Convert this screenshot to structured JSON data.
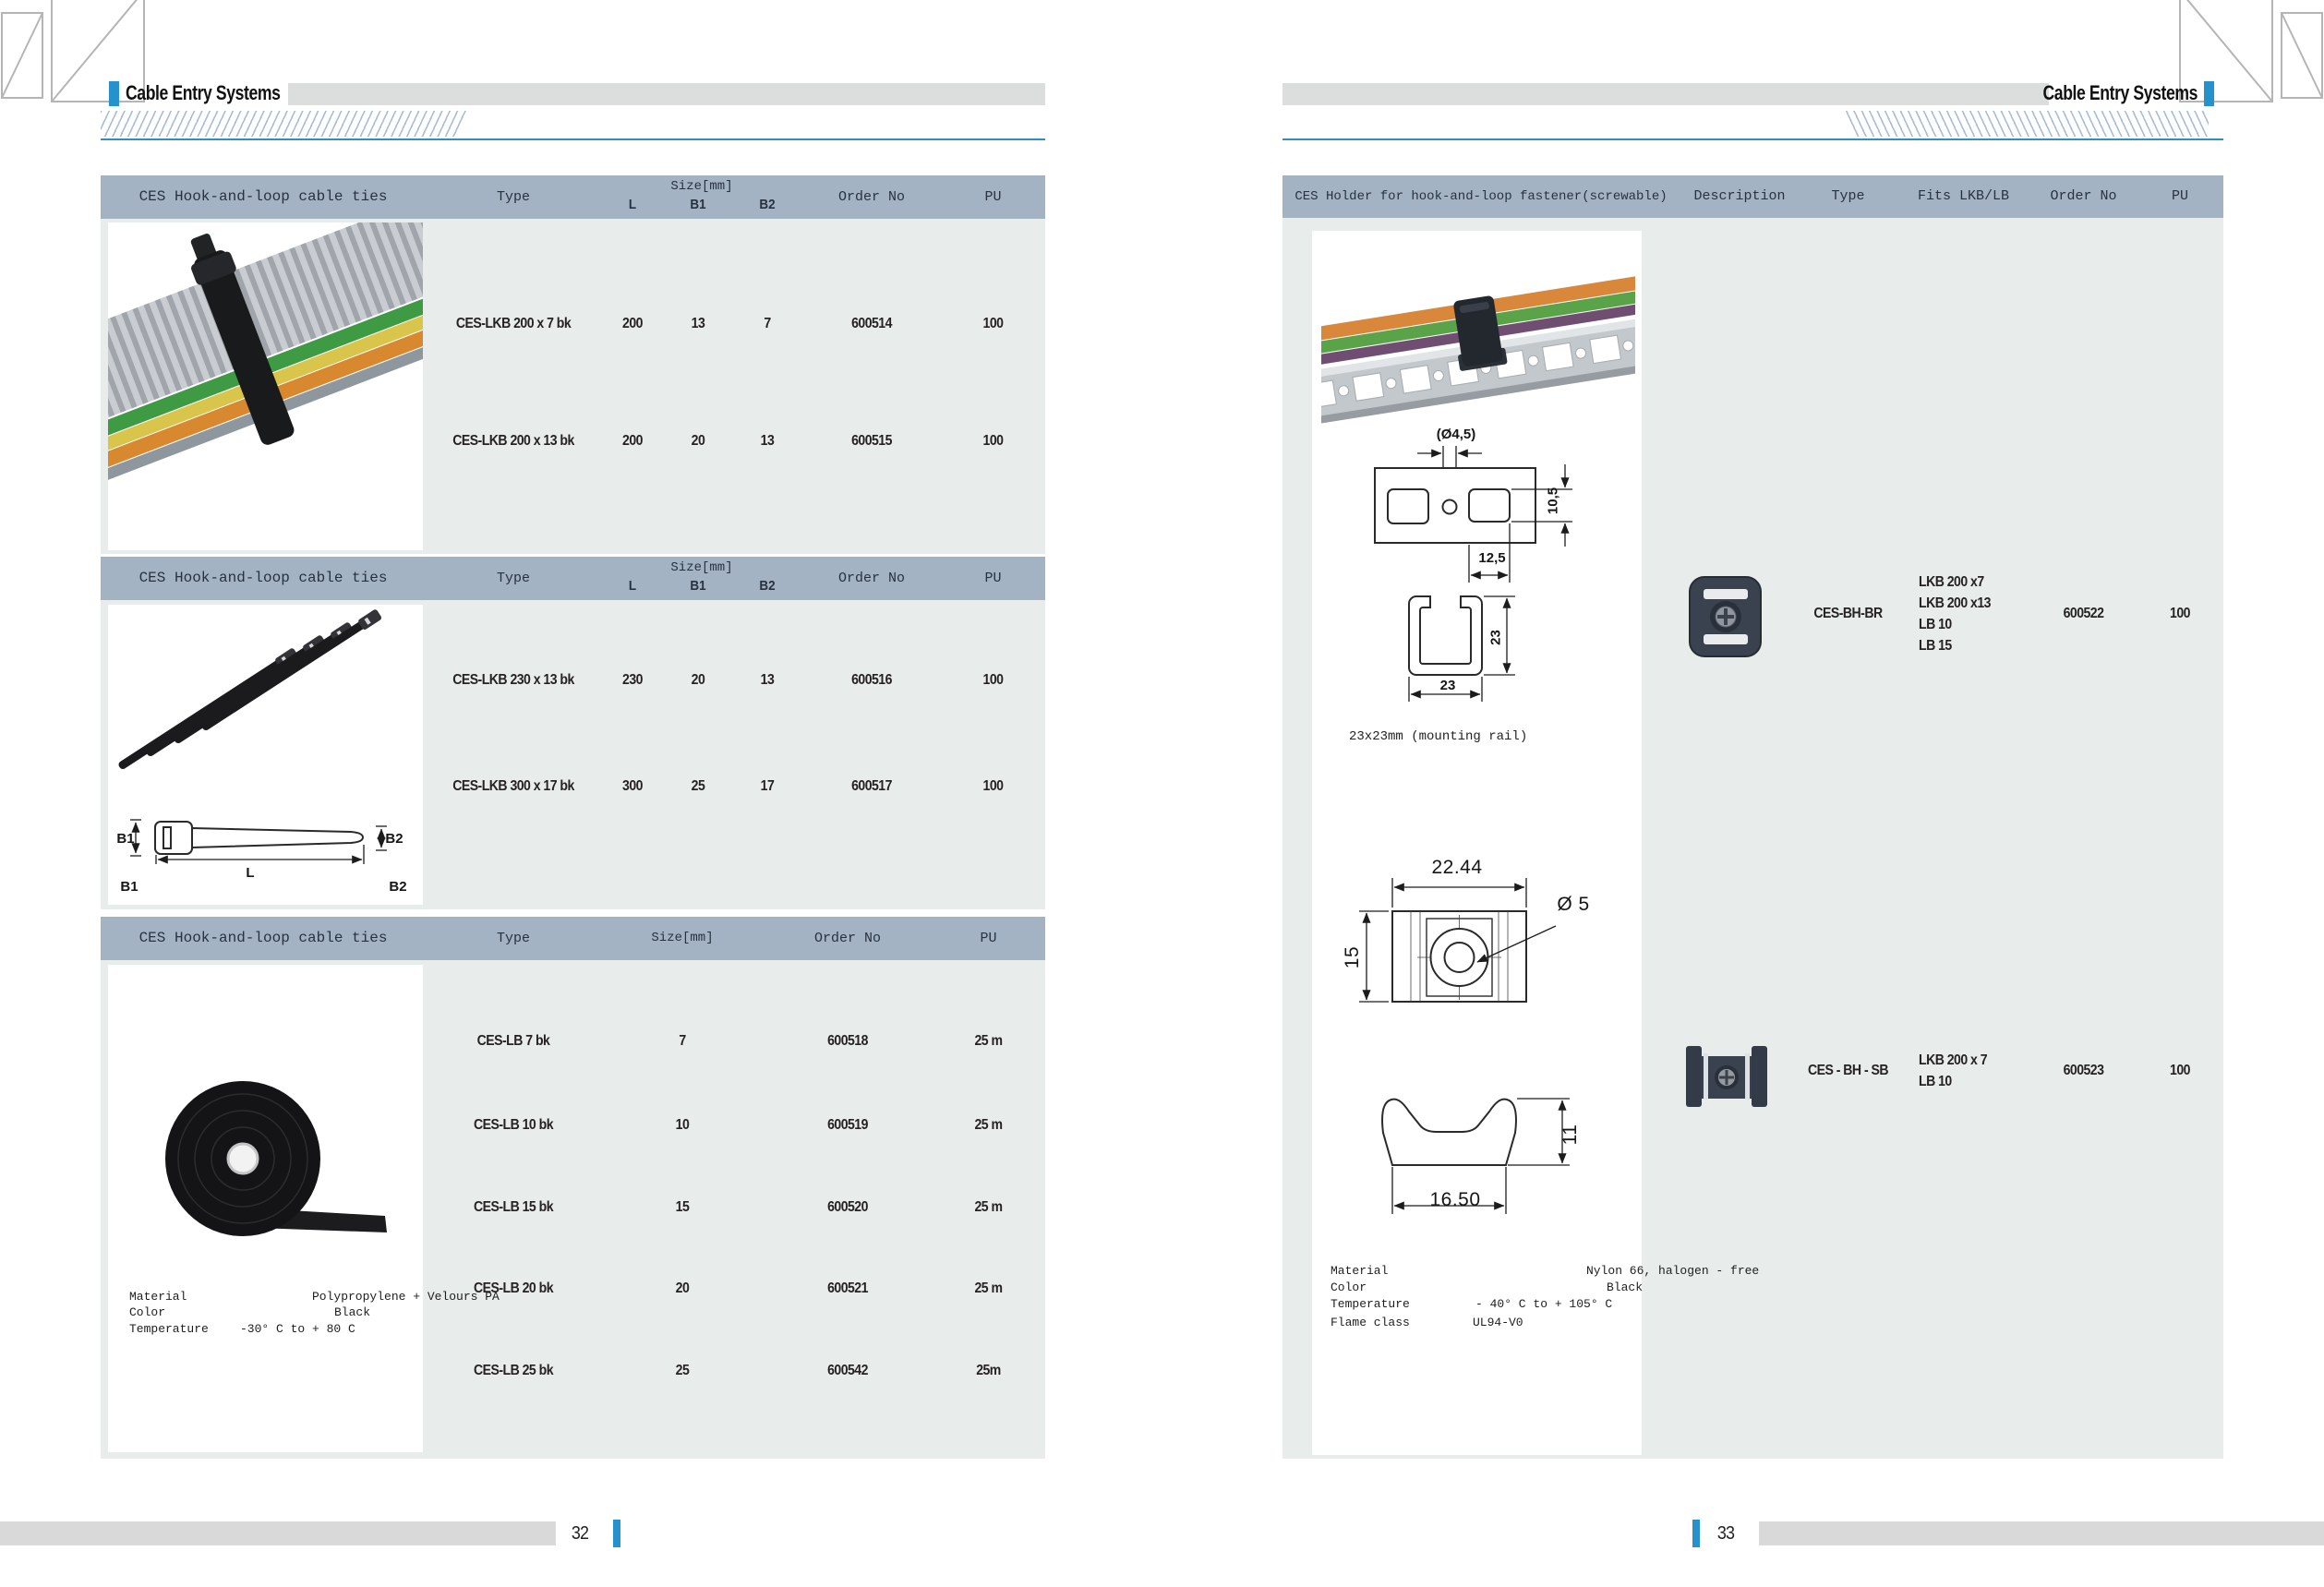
{
  "colors": {
    "accent_blue": "#2591cd",
    "header_band": "#a4b3c3",
    "table_body": "#e8eceb",
    "gray_band": "#dcdddd"
  },
  "left_page": {
    "header_title": "Cable Entry Systems",
    "page_number": "32",
    "lkb_columns": {
      "title": "CES Hook-and-loop cable ties",
      "type": "Type",
      "size": "Size[mm]",
      "l": "L",
      "b1": "B1",
      "b2": "B2",
      "order": "Order No",
      "pu": "PU"
    },
    "table1_rows": [
      {
        "type": "CES-LKB 200 x 7 bk",
        "l": "200",
        "b1": "13",
        "b2": "7",
        "order": "600514",
        "pu": "100"
      },
      {
        "type": "CES-LKB 200 x 13 bk",
        "l": "200",
        "b1": "20",
        "b2": "13",
        "order": "600515",
        "pu": "100"
      }
    ],
    "table2_rows": [
      {
        "type": "CES-LKB 230 x 13 bk",
        "l": "230",
        "b1": "20",
        "b2": "13",
        "order": "600516",
        "pu": "100"
      },
      {
        "type": "CES-LKB 300 x 17 bk",
        "l": "300",
        "b1": "25",
        "b2": "17",
        "order": "600517",
        "pu": "100"
      }
    ],
    "table3_cols": {
      "title": "CES Hook-and-loop cable ties",
      "type": "Type",
      "size": "Size[mm]",
      "order": "Order No",
      "pu": "PU"
    },
    "table3_rows": [
      {
        "type": "CES-LB 7 bk",
        "size": "7",
        "order": "600518",
        "pu": "25 m"
      },
      {
        "type": "CES-LB 10 bk",
        "size": "10",
        "order": "600519",
        "pu": "25 m"
      },
      {
        "type": "CES-LB 15 bk",
        "size": "15",
        "order": "600520",
        "pu": "25 m"
      },
      {
        "type": "CES-LB 20 bk",
        "size": "20",
        "order": "600521",
        "pu": "25 m"
      },
      {
        "type": "CES-LB 25 bk",
        "size": "25",
        "order": "600542",
        "pu": "25m"
      }
    ],
    "tie_diagram": {
      "b1": "B1",
      "b2": "B2",
      "l": "L"
    },
    "material": {
      "material_label": "Material",
      "material_value": "Polypropylene + Velours PA",
      "color_label": "Color",
      "color_value": "Black",
      "temp_label": "Temperature",
      "temp_value": "-30° C to + 80 C"
    }
  },
  "right_page": {
    "header_title": "Cable Entry Systems",
    "page_number": "33",
    "table_cols": {
      "title": "CES Holder for hook-and-loop fastener(screwable)",
      "description": "Description",
      "type": "Type",
      "fits": "Fits LKB/LB",
      "order": "Order No",
      "pu": "PU"
    },
    "rows": [
      {
        "type": "CES-BH-BR",
        "fits": [
          "LKB 200 x7",
          "LKB 200 x13",
          "LB 10",
          "LB 15"
        ],
        "order": "600522",
        "pu": "100"
      },
      {
        "type": "CES - BH - SB",
        "fits": [
          "LKB 200 x 7",
          "LB 10"
        ],
        "order": "600523",
        "pu": "100"
      }
    ],
    "rail_drawing": {
      "hole_dia": "(Ø4,5)",
      "slot_height": "10,5",
      "slot_width": "12,5",
      "profile_height": "23",
      "profile_width": "23",
      "caption": "23x23mm (mounting rail)"
    },
    "holder_drawing": {
      "width": "22.44",
      "height": "15",
      "hole_dia": "Ø 5",
      "base_width": "16.50",
      "base_height": "11"
    },
    "material": {
      "material_label": "Material",
      "material_value": "Nylon 66, halogen - free",
      "color_label": "Color",
      "color_value": "Black",
      "temp_label": "Temperature",
      "temp_value": "- 40° C to + 105° C",
      "flame_label": "Flame class",
      "flame_value": "UL94-V0"
    }
  }
}
